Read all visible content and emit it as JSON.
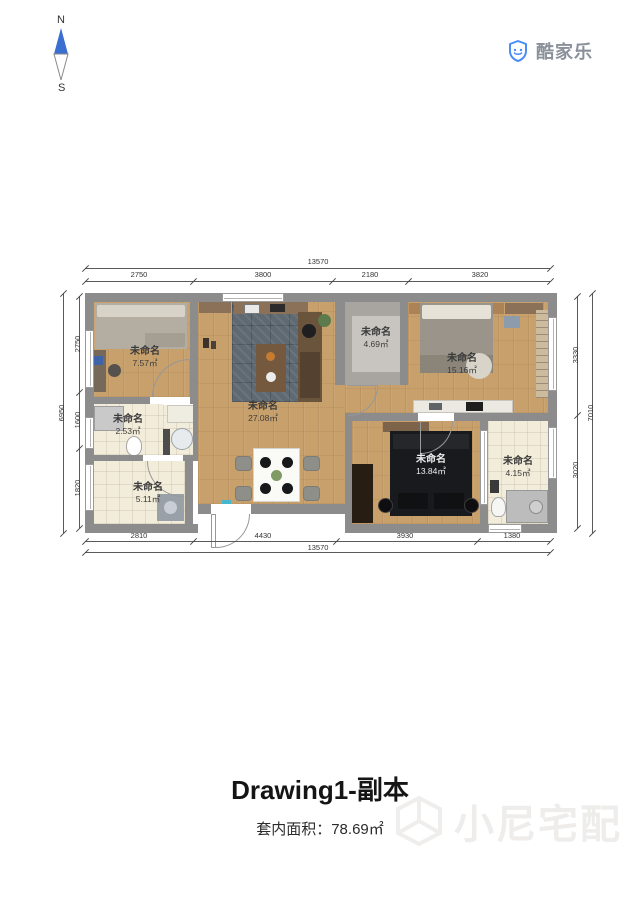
{
  "compass": {
    "north": "N",
    "south": "S"
  },
  "brand": {
    "name": "酷家乐"
  },
  "plan": {
    "rooms": [
      {
        "name": "未命名",
        "area": "7.57㎡"
      },
      {
        "name": "未命名",
        "area": "2.53㎡"
      },
      {
        "name": "未命名",
        "area": "5.11㎡"
      },
      {
        "name": "未命名",
        "area": "27.08㎡"
      },
      {
        "name": "未命名",
        "area": "4.69㎡"
      },
      {
        "name": "未命名",
        "area": "15.16㎡"
      },
      {
        "name": "未命名",
        "area": "13.84㎡"
      },
      {
        "name": "未命名",
        "area": "4.15㎡"
      }
    ],
    "dims": {
      "top_total": "13570",
      "top": [
        "2750",
        "3800",
        "2180",
        "3820"
      ],
      "bottom": [
        "2810",
        "4430",
        "3930",
        "1380"
      ],
      "bottom_total": "13570",
      "left_total": "6950",
      "left": [
        "2750",
        "1600",
        "1820"
      ],
      "right": [
        "3330",
        "3020"
      ],
      "right_total": "7010"
    }
  },
  "footer": {
    "title": "Drawing1-副本",
    "area_text": "套内面积：78.69㎡"
  },
  "watermark": {
    "text": "小尼宅配"
  },
  "colors": {
    "wall": "#8c8c8c",
    "wood_floor": "#c8a06c",
    "brand_blue": "#4a8df8"
  }
}
